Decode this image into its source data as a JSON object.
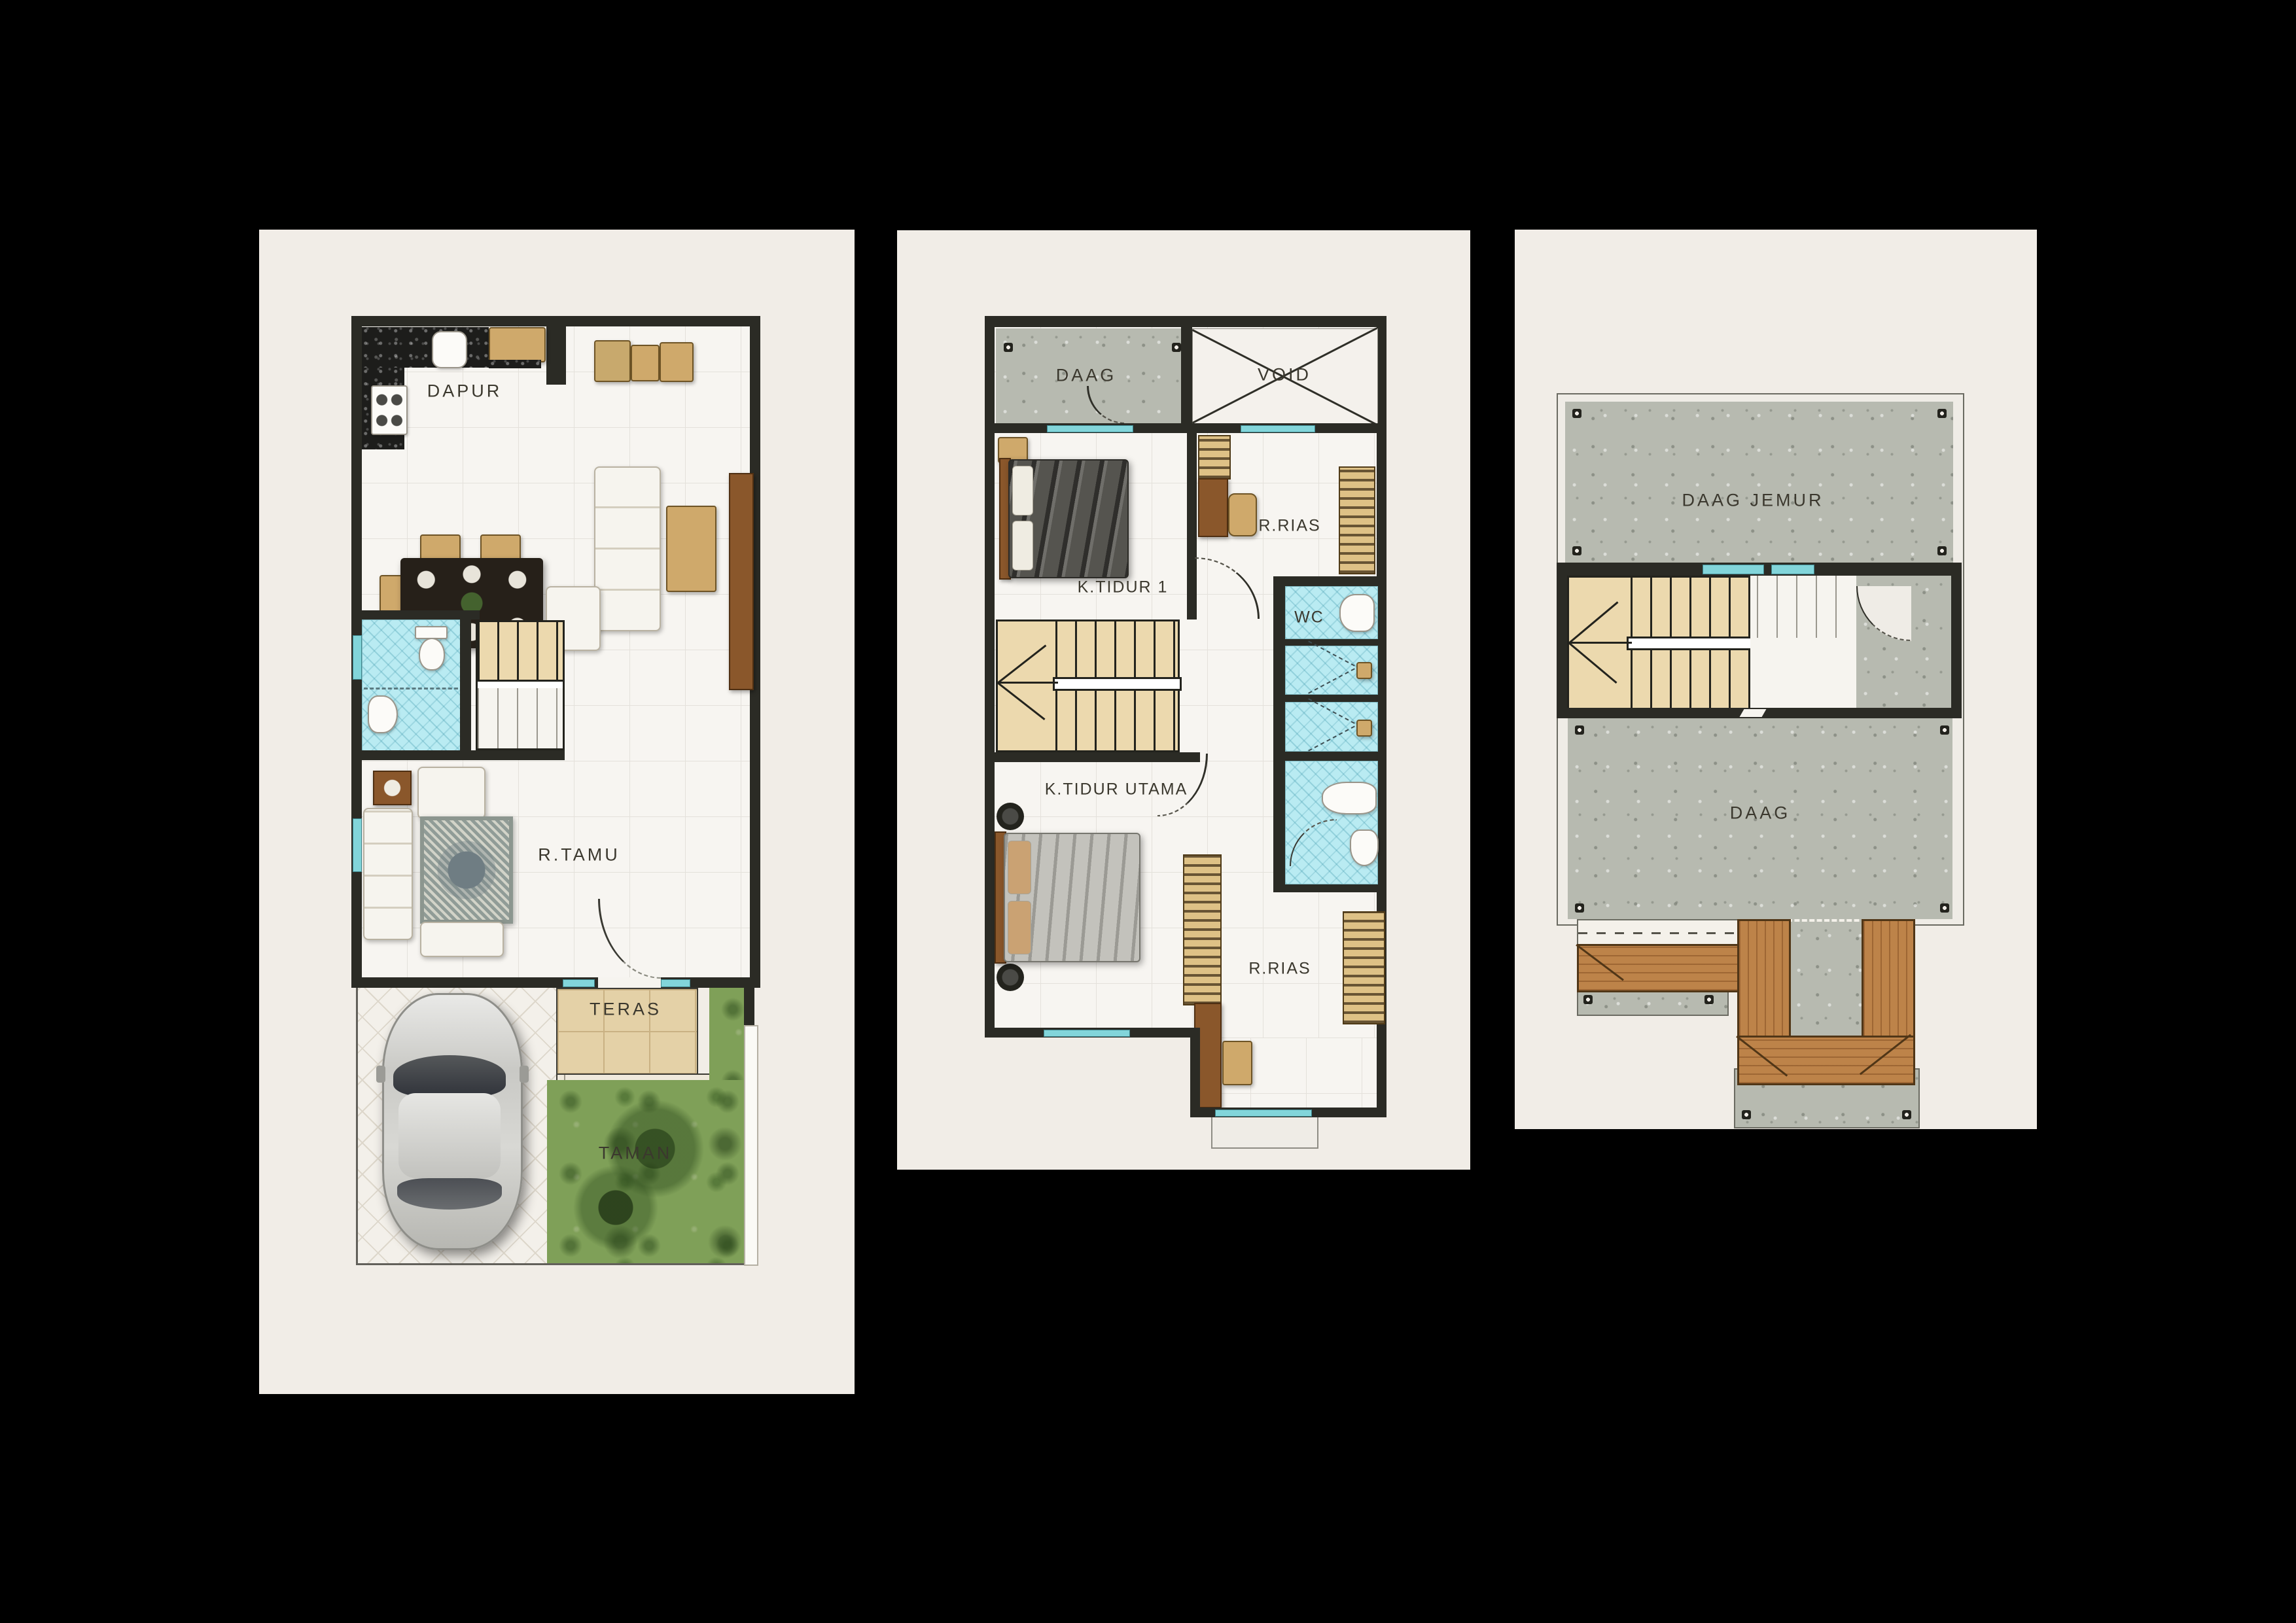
{
  "poster": {
    "background": "#000000",
    "panel_color": "#f1ede7",
    "wall_color": "#2b2b25",
    "window_color": "#82d5da",
    "bathroom_tile_color": "#b9ebf2",
    "stair_color": "#ecd9ae",
    "concrete_color": "#b7bab0",
    "grass_color": "#7fa058",
    "terrace_color": "#e4d1a7",
    "roof_wood_color": "#bd8349"
  },
  "plans": {
    "ground": {
      "labels": {
        "dapur": "DAPUR",
        "r_tamu": "R.TAMU",
        "teras": "TERAS",
        "taman": "TAMAN"
      }
    },
    "upper": {
      "labels": {
        "daag": "DAAG",
        "void": "VOID",
        "k_tidur_1": "K.TIDUR 1",
        "r_rias_top": "R.RIAS",
        "wc": "WC",
        "k_tidur_utama": "K.TIDUR UTAMA",
        "r_rias_bottom": "R.RIAS"
      }
    },
    "roof": {
      "labels": {
        "daag_jemur": "DAAG JEMUR",
        "daag": "DAAG"
      }
    }
  }
}
